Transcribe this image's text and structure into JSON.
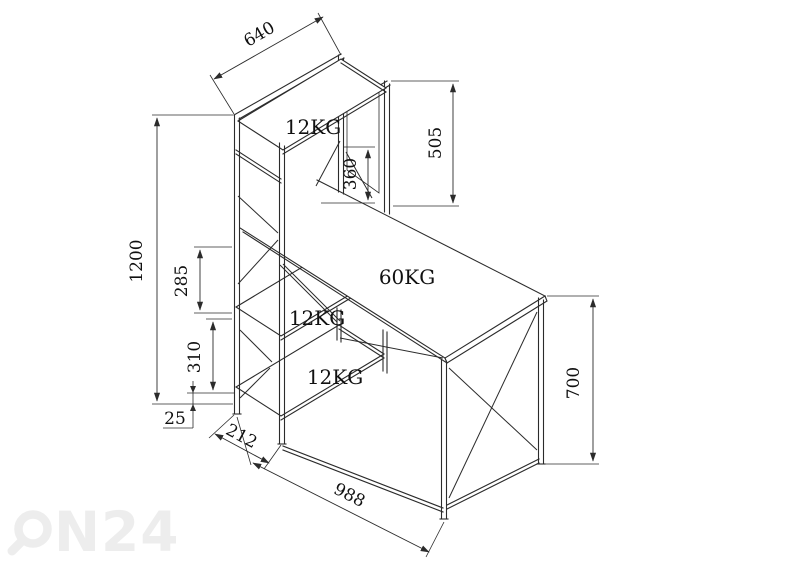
{
  "diagram": {
    "title_hint": "desk with shelf tower dimensional drawing",
    "dimensions": {
      "top_shelf_length": "640",
      "panel_height": "505",
      "riser_height": "360",
      "tower_height": "1200",
      "upper_shelf_gap": "285",
      "lower_shelf_gap": "310",
      "bottom_clearance": "25",
      "tower_depth": "212",
      "desk_length": "988",
      "desk_height": "700"
    },
    "loads": {
      "top_shelf": "12KG",
      "desktop": "60KG",
      "middle_shelf": "12KG",
      "bottom_shelf": "12KG"
    },
    "watermark": {
      "brand": "ON24",
      "brand_tail": "N24"
    },
    "colors": {
      "line": "#2b2b2b",
      "text": "#111111",
      "watermark": "#ededed",
      "background": "#ffffff"
    }
  }
}
